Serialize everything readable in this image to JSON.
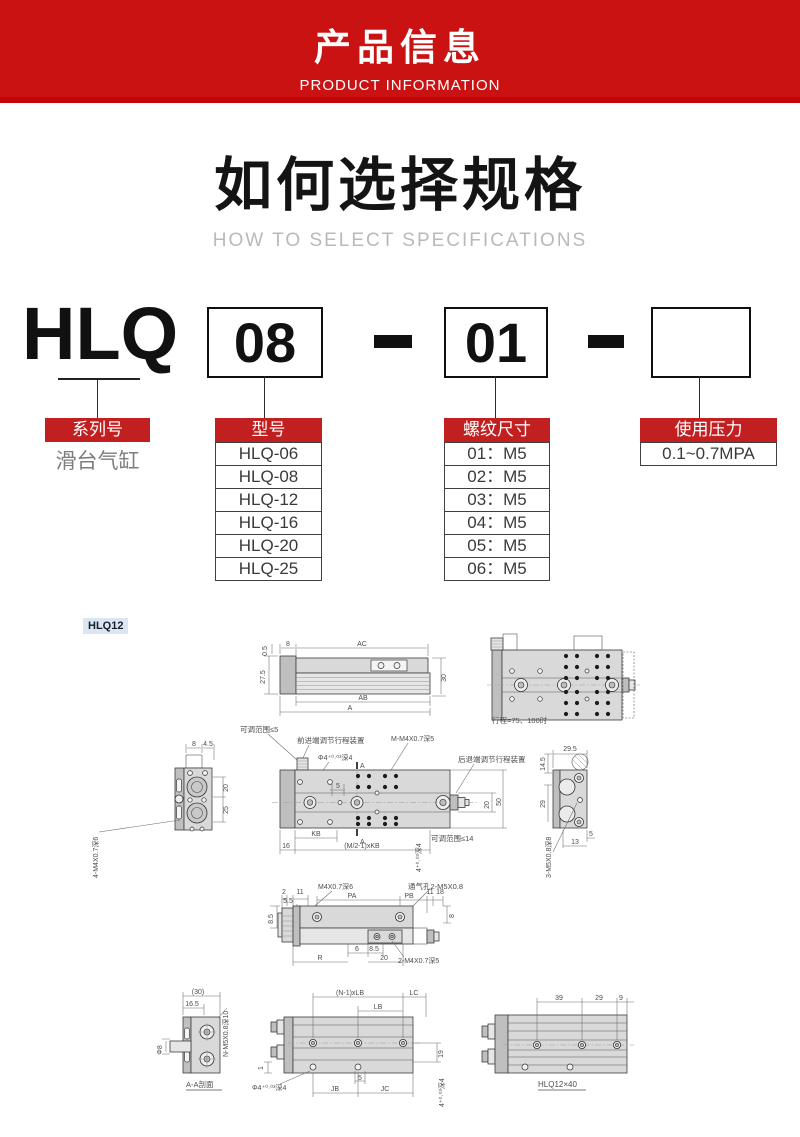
{
  "banner": {
    "title": "产品信息",
    "subtitle": "PRODUCT INFORMATION"
  },
  "howto": {
    "title": "如何选择规格",
    "subtitle": "HOW TO SELECT SPECIFICATIONS"
  },
  "selector": {
    "series_code": "HLQ",
    "bore_code": "08",
    "thread_code": "01",
    "separator": "-",
    "columns": [
      {
        "header": "系列号",
        "items": [
          "滑台气缸"
        ]
      },
      {
        "header": "型号",
        "items": [
          "HLQ-06",
          "HLQ-08",
          "HLQ-12",
          "HLQ-16",
          "HLQ-20",
          "HLQ-25"
        ]
      },
      {
        "header": "螺纹尺寸",
        "items": [
          "01：M5",
          "02：M5",
          "03：M5",
          "04：M5",
          "05：M5",
          "06：M5"
        ]
      },
      {
        "header": "使用压力",
        "items": [
          "0.1~0.7MPA"
        ]
      }
    ]
  },
  "drawings": {
    "chip": "HLQ12",
    "d1": {
      "dim_05": "0.5",
      "dim_8": "8",
      "dim_ac": "AC",
      "dim_275": "27.5",
      "dim_30": "30",
      "dim_ab": "AB",
      "dim_a": "A"
    },
    "d2": {
      "note": "行程=75、100时"
    },
    "d3": {
      "dim_8": "8",
      "dim_45": "4.5",
      "dim_20": "20",
      "dim_25": "25",
      "thread": "4-M4X0.7深6"
    },
    "d4": {
      "note_adj5": "可调范围≤5",
      "fwd": "前进端调节行程装置",
      "m_thread": "M-M4X0.7深5",
      "phi4": "Φ4⁺⁰·⁰³深4",
      "back": "后退端调节行程装置",
      "dim_5": "5",
      "sec_a_top": "A",
      "sec_a_bot": "A",
      "dim_kb": "KB",
      "dim_16": "16",
      "dim_mkb": "(M/2-1)xKB",
      "tol4": "4⁺⁰·⁰³深4",
      "dim_20": "20",
      "dim_50": "50",
      "note_adj14": "可调范围≤14"
    },
    "d5": {
      "dim_295": "29.5",
      "dim_145": "14.5",
      "dim_29": "29",
      "dim_5": "5",
      "dim_13": "13",
      "thread": "3-M5X0.8深8"
    },
    "d6": {
      "dim_2": "2",
      "dim_11": "11",
      "dim_55": "5.5",
      "thread_m4": "M4X0.7深6",
      "vent": "通气孔2-M5X0.8",
      "dim_pa": "PA",
      "dim_pb": "PB",
      "dim_11b": "11",
      "dim_18": "18",
      "dim_85": "8.5",
      "dim_8": "8",
      "dim_6": "6",
      "dim_85b": "8.5",
      "dim_r": "R",
      "dim_20": "20",
      "thread_2m4": "2-M4X0.7深5"
    },
    "d7": {
      "dim_30": "(30)",
      "dim_165": "16.5",
      "dim_phi8": "Φ8",
      "thread": "N-M5X0.8深10",
      "label": "A-A剖面"
    },
    "d8": {
      "dim_nlb": "(N-1)xLB",
      "dim_lb": "LB",
      "dim_lc": "LC",
      "dim_19": "19",
      "dim_1": "1",
      "phi4": "Φ4⁺⁰·⁰³深4",
      "dim_jb": "JB",
      "dim_jc": "JC",
      "dim_5": "5",
      "tol4": "4⁺⁰·⁰³深4"
    },
    "d9": {
      "dim_39": "39",
      "dim_29": "29",
      "dim_9": "9",
      "label": "HLQ12×40"
    }
  }
}
